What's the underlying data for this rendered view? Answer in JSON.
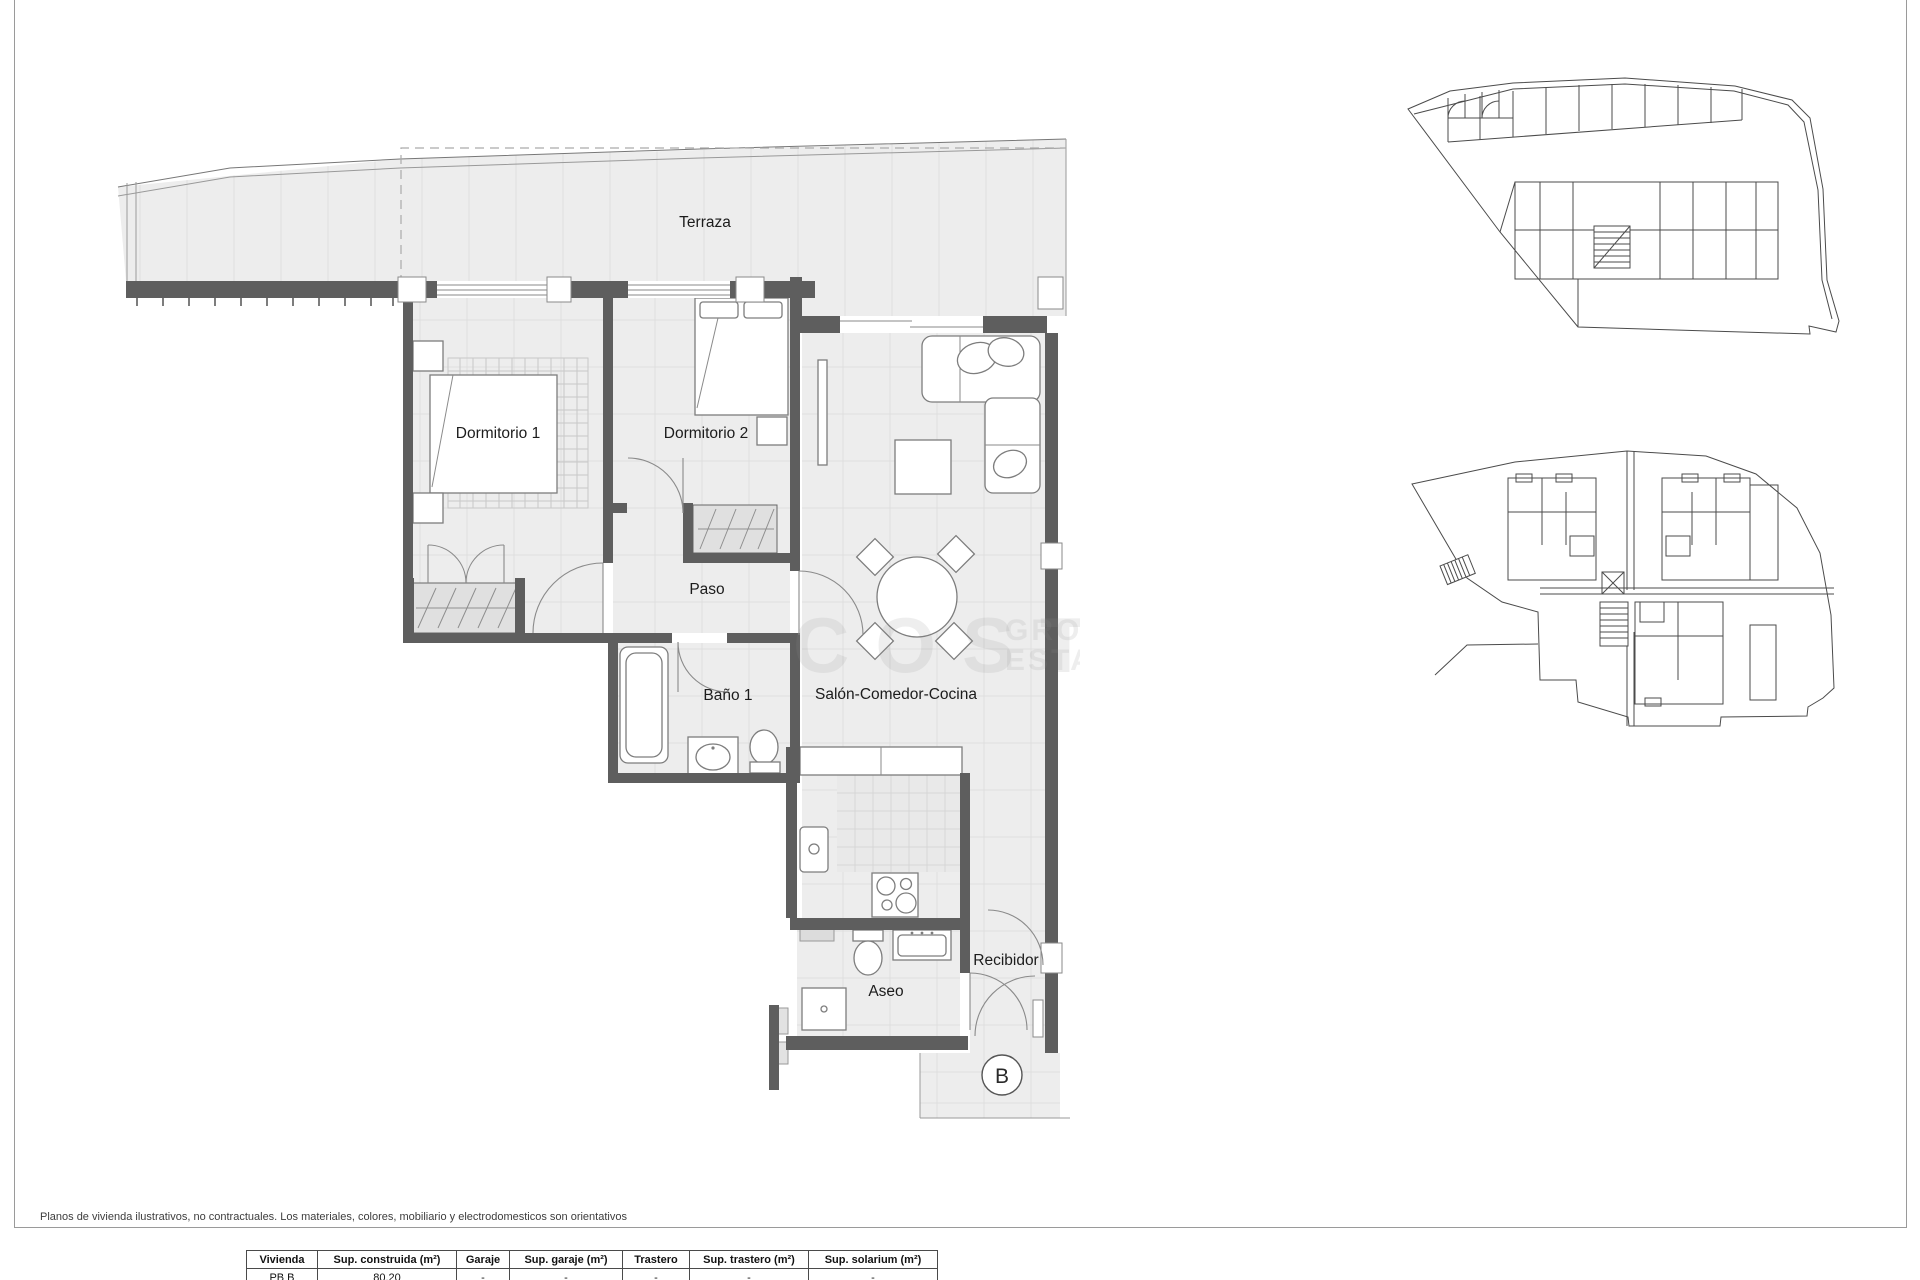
{
  "main_plan": {
    "rooms": [
      {
        "id": "terraza",
        "label": "Terraza"
      },
      {
        "id": "dormitorio-1",
        "label": "Dormitorio 1"
      },
      {
        "id": "dormitorio-2",
        "label": "Dormitorio 2"
      },
      {
        "id": "paso",
        "label": "Paso"
      },
      {
        "id": "bano-1",
        "label": "Baño 1"
      },
      {
        "id": "salon-comedor-cocina",
        "label": "Salón-Comedor-Cocina"
      },
      {
        "id": "aseo",
        "label": "Aseo"
      },
      {
        "id": "recibidor",
        "label": "Recibidor"
      }
    ],
    "unit_marker": "B"
  },
  "watermark": {
    "large": "COSTA",
    "small_top": "GRO",
    "small_bottom": "ESTA"
  },
  "disclaimer": {
    "text": "Planos de vivienda ilustrativos, no contractuales. Los materiales, colores, mobiliario y electrodomesticos son orientativos"
  },
  "table": {
    "columns": [
      "Vivienda",
      "Sup. construida (m²)",
      "Garaje",
      "Sup. garaje (m²)",
      "Trastero",
      "Sup. trastero (m²)",
      "Sup. solarium (m²)"
    ],
    "rows": [
      [
        "PB B",
        "80.20",
        "-",
        "-",
        "-",
        "-",
        "-"
      ]
    ]
  },
  "colors": {
    "wall": "#5e5e5e",
    "floor": "#ededed",
    "tile_line": "#dedede",
    "frame": "#9a9a9a"
  }
}
